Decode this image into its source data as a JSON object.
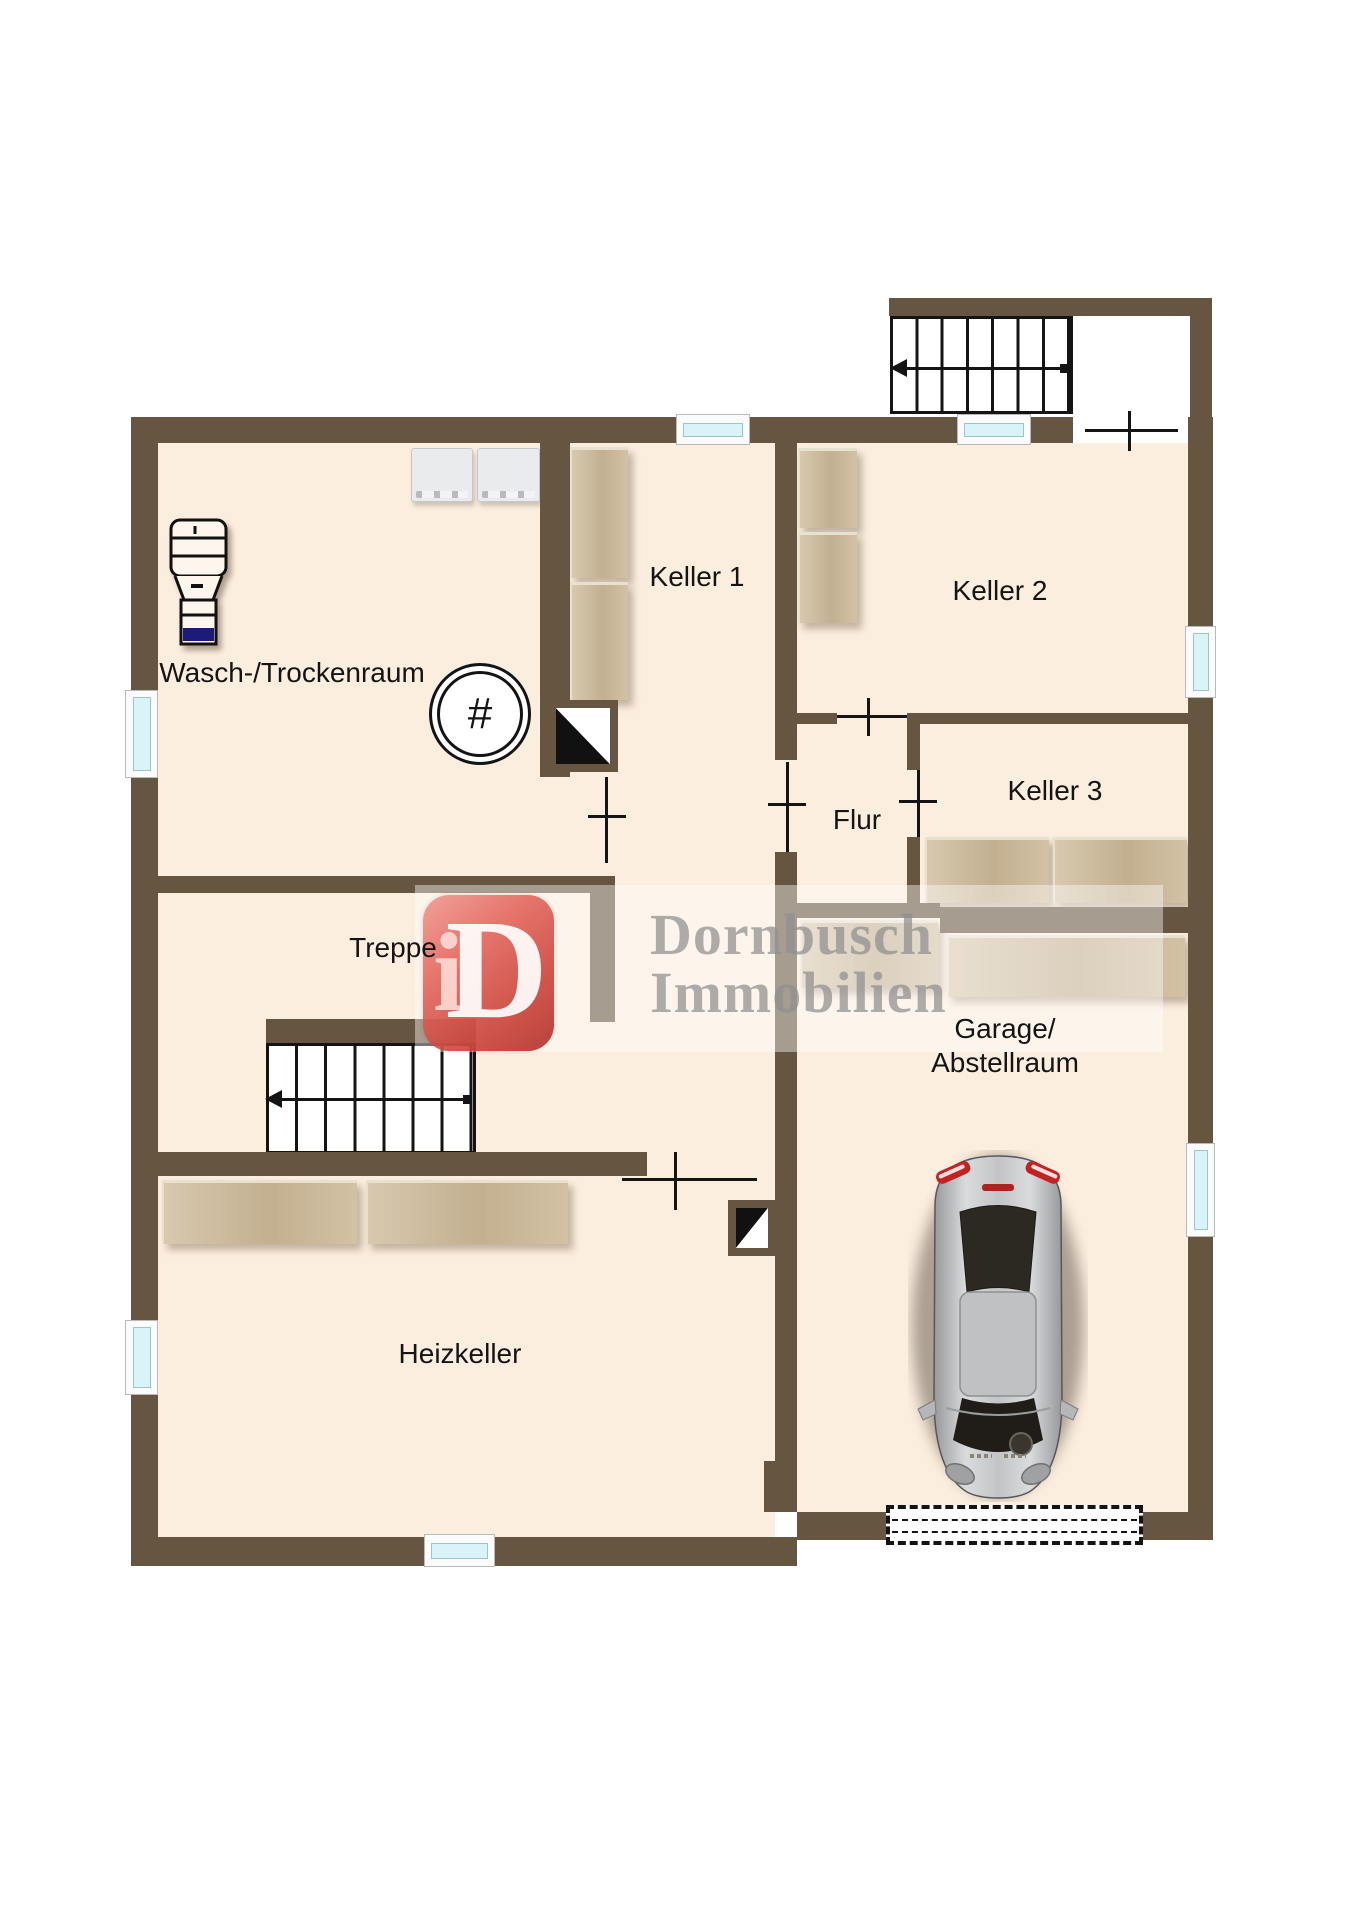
{
  "plan": {
    "rooms": {
      "wasch": {
        "label": "Wasch-/Trockenraum"
      },
      "keller1": {
        "label": "Keller 1"
      },
      "keller2": {
        "label": "Keller 2"
      },
      "keller3": {
        "label": "Keller 3"
      },
      "flur": {
        "label": "Flur"
      },
      "treppe": {
        "label": "Treppe"
      },
      "heizkeller": {
        "label": "Heizkeller"
      },
      "garage": {
        "label_line1": "Garage/",
        "label_line2": "Abstellraum"
      }
    },
    "watermark": {
      "logo_i": "i",
      "logo_d": "D",
      "line1": "Dornbusch",
      "line2": "Immobilien"
    },
    "symbols": {
      "drain": "#"
    },
    "colors": {
      "wall": "#665540",
      "floor": "#fceede",
      "shelf": "#cdb998",
      "shelf_edge": "#e9e1cf",
      "glass": "#d9f4f9",
      "line": "#141414",
      "navy": "#1c1c78",
      "machine": "#e9ebed",
      "logo_red": "#d9534f",
      "watermark_gray": "#8f8f8f",
      "car_body": "#c6c8ca"
    }
  }
}
